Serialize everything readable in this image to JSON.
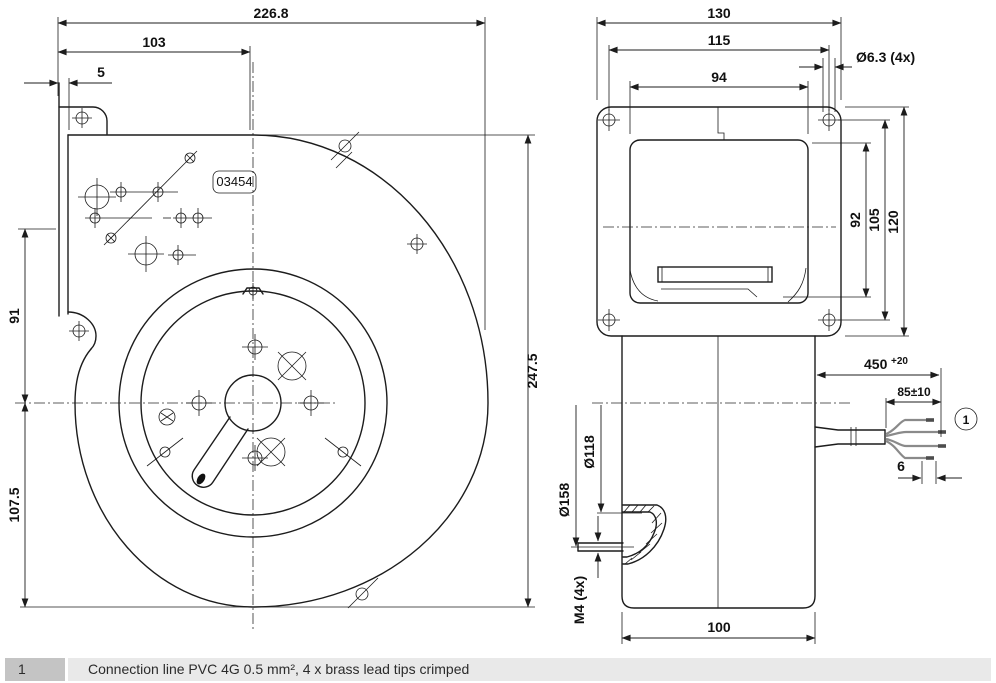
{
  "drawing": {
    "front_view": {
      "dims": {
        "overall_width": "226.8",
        "outlet_width": "103",
        "flange_offset": "5",
        "upper_height": "91",
        "lower_height": "107.5",
        "overall_height": "247.5"
      },
      "part_label": "03454"
    },
    "side_view": {
      "dims": {
        "flange_width": "130",
        "hole_spacing_h": "115",
        "housing_width": "94",
        "hole_diameter": "Ø6.3 (4x)",
        "housing_height": "92",
        "hole_spacing_v": "105",
        "flange_height": "120",
        "cable_length": "450",
        "cable_length_tol": "+20",
        "strip_length": "85±10",
        "tip_length": "6",
        "inlet_inner_diameter": "Ø118",
        "inlet_outer_diameter": "Ø158",
        "stud_thread": "M4 (4x)",
        "motor_depth": "100"
      },
      "callout": "1"
    },
    "notes": [
      {
        "index": "1",
        "text": "Connection line PVC 4G 0.5 mm², 4 x brass lead tips crimped"
      }
    ]
  }
}
